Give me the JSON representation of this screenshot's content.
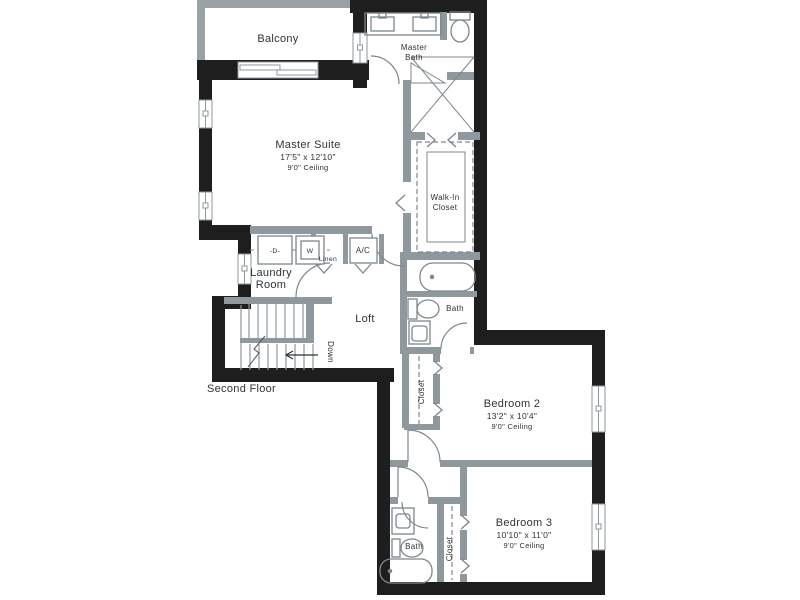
{
  "floor_plan": {
    "floor_label": "Second Floor",
    "colors": {
      "exterior_wall": "#1e1e1e",
      "interior_wall": "#8e989d",
      "balcony_wall": "#9aa1a5",
      "fixture_line": "#7d878c",
      "text": "#2e3438",
      "background": "#ffffff"
    },
    "rooms": {
      "balcony": {
        "name": "Balcony"
      },
      "master_bath": {
        "lines": [
          "Master",
          "Bath"
        ]
      },
      "master_suite": {
        "name": "Master Suite",
        "dimensions": "17'5\" x 12'10\"",
        "ceiling": "9'0\" Ceiling"
      },
      "walk_in_closet": {
        "lines": [
          "Walk-In",
          "Closet"
        ]
      },
      "laundry_room": {
        "lines": [
          "Laundry",
          "Room"
        ]
      },
      "linen_closet": {
        "name": "Linen"
      },
      "ac_closet": {
        "name": "A/C"
      },
      "loft": {
        "name": "Loft"
      },
      "bath_2": {
        "name": "Bath"
      },
      "closet_2": {
        "name": "Closet"
      },
      "bedroom_2": {
        "name": "Bedroom 2",
        "dimensions": "13'2\" x 10'4\"",
        "ceiling": "9'0\" Ceiling"
      },
      "bath_3": {
        "name": "Bath"
      },
      "closet_3": {
        "name": "Closet"
      },
      "bedroom_3": {
        "name": "Bedroom 3",
        "dimensions": "10'10\" x 11'0\"",
        "ceiling": "9'0\" Ceiling"
      }
    },
    "appliances": {
      "dryer": "-D-",
      "washer": "W"
    },
    "stairs": {
      "label": "Down"
    }
  }
}
